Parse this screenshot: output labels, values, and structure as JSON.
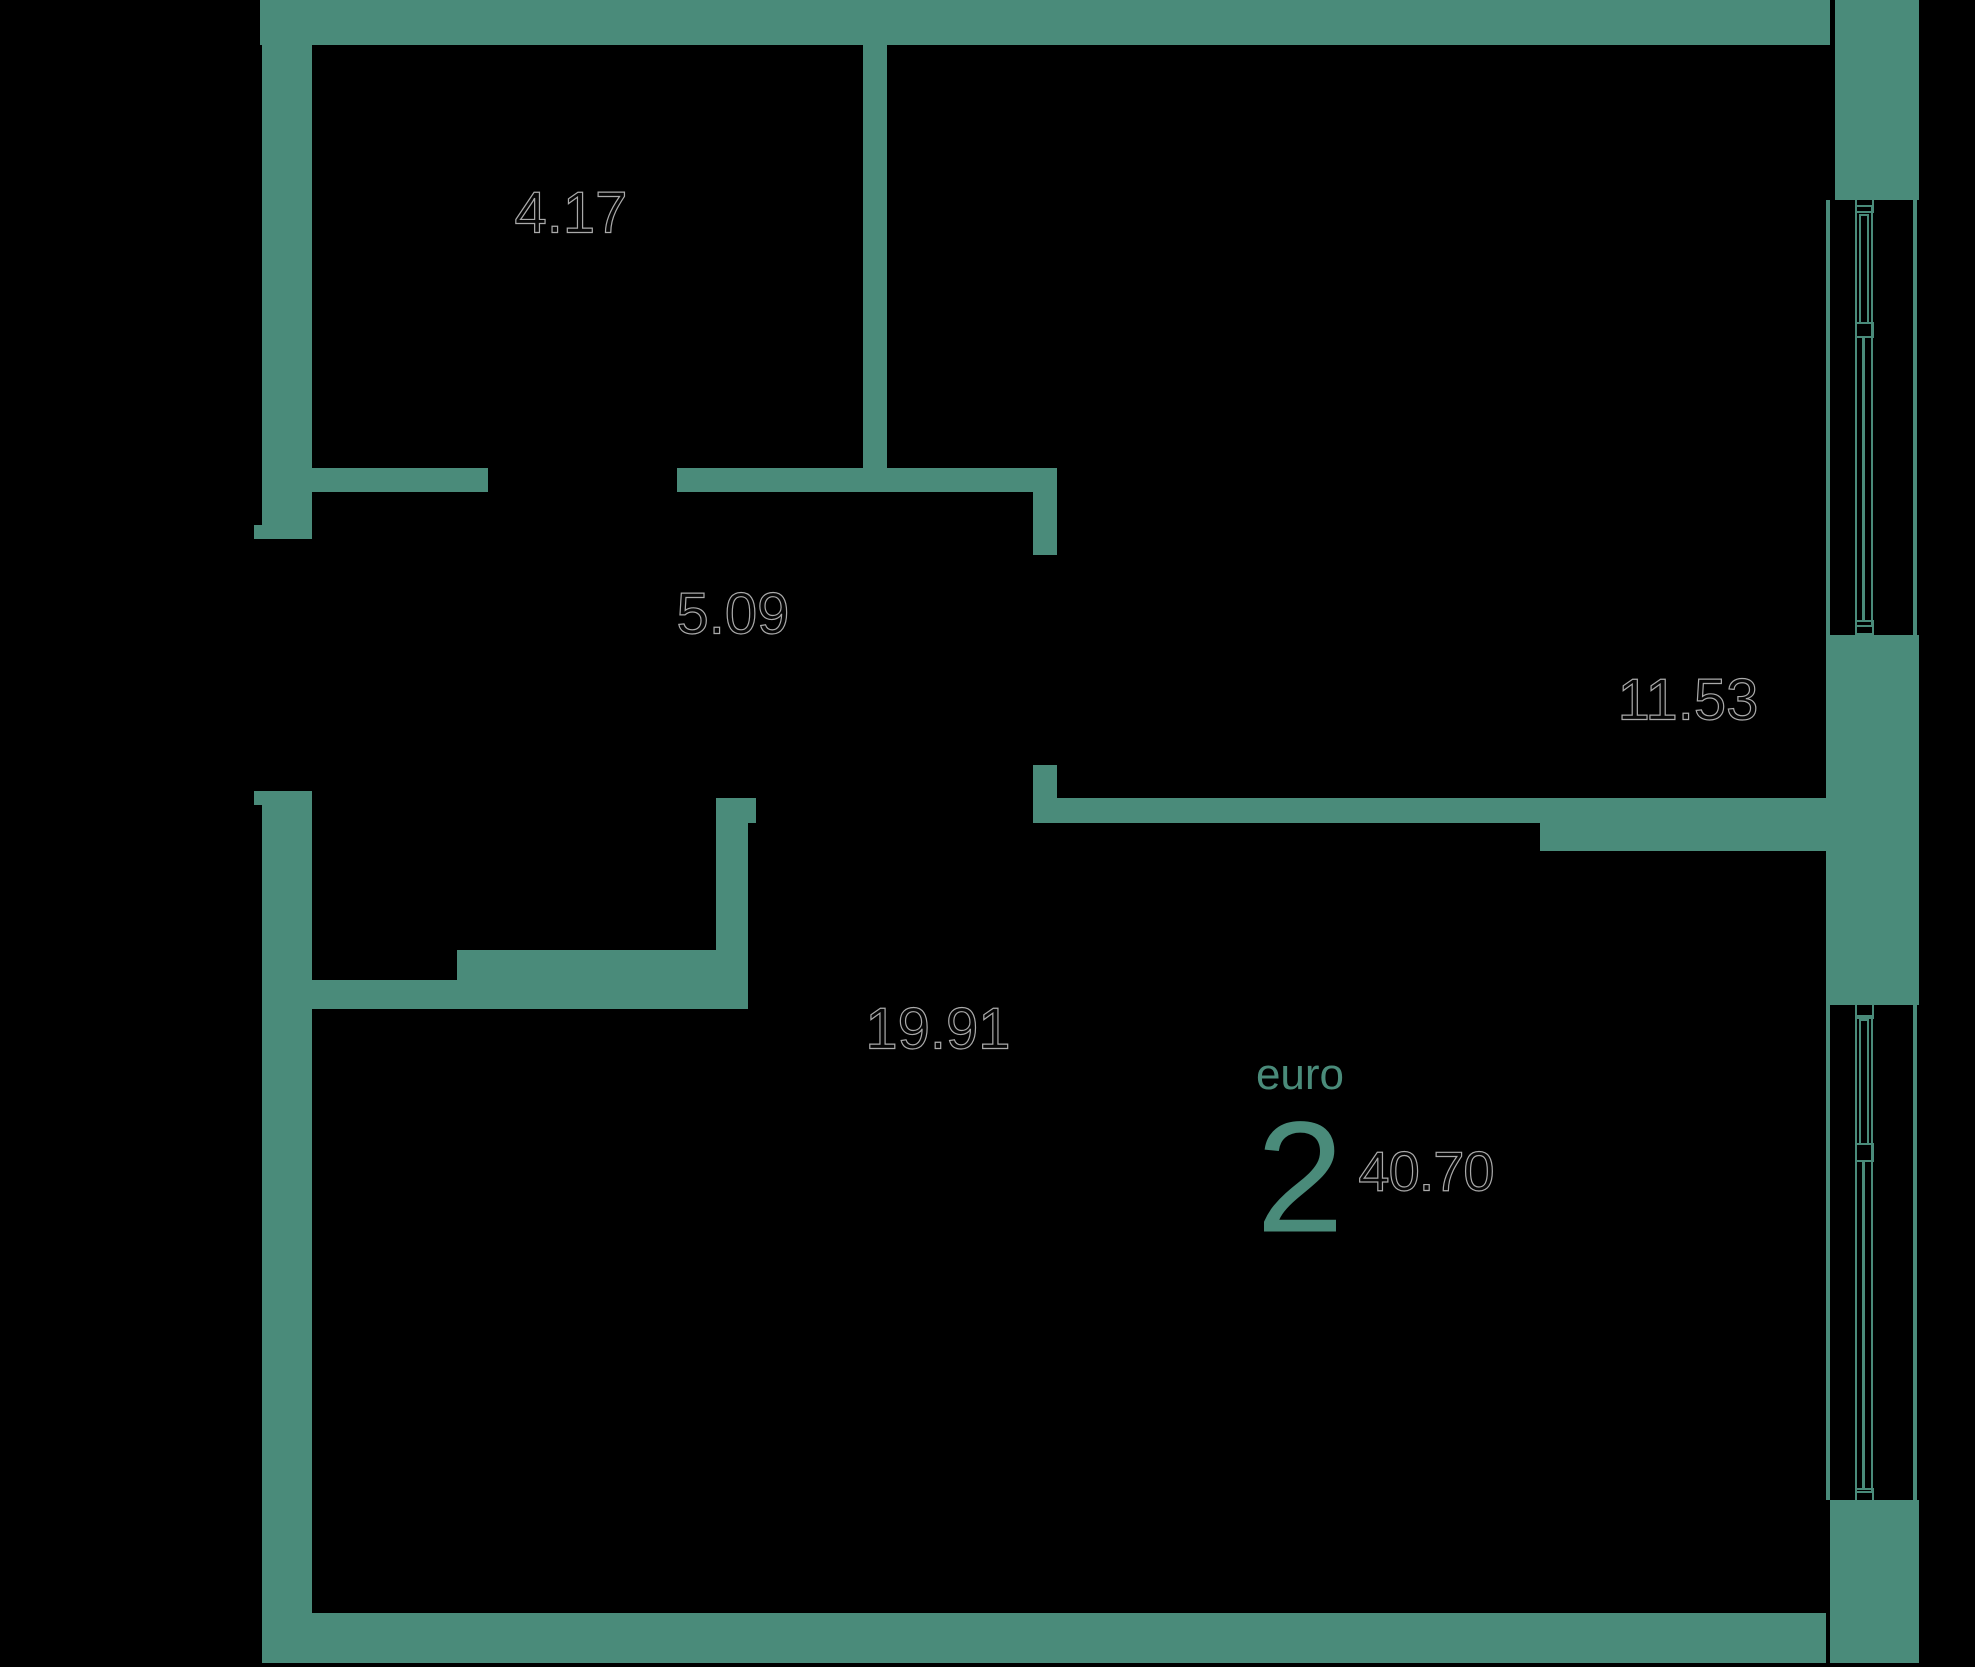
{
  "floorplan": {
    "title": "apartment-floor-plan",
    "colors": {
      "wall": "#4a8b7a",
      "background": "#000000",
      "dimension_text_fill": "#050505",
      "dimension_text_outline": "#aaaaaa",
      "accent_text": "#4a8b7a"
    },
    "rooms": [
      {
        "name": "bathroom",
        "area": "4.17"
      },
      {
        "name": "hallway",
        "area": "5.09"
      },
      {
        "name": "bedroom",
        "area": "11.53"
      },
      {
        "name": "living-kitchen",
        "area": "19.91"
      }
    ],
    "badge": {
      "layout_label": "euro",
      "rooms_count": "2",
      "total_area": "40.70"
    }
  },
  "geometry": {
    "solids": [
      {
        "x": 260,
        "y": 0,
        "w": 1570,
        "h": 45,
        "name": "top-outer-wall"
      },
      {
        "x": 1835,
        "y": 0,
        "w": 84,
        "h": 200,
        "name": "top-right-corner-block"
      },
      {
        "x": 262,
        "y": 0,
        "w": 50,
        "h": 539,
        "name": "left-outer-wall-upper"
      },
      {
        "x": 254,
        "y": 525,
        "w": 10,
        "h": 14,
        "name": "left-door-jamb-upper"
      },
      {
        "x": 262,
        "y": 791,
        "w": 50,
        "h": 872,
        "name": "left-outer-wall-lower"
      },
      {
        "x": 254,
        "y": 791,
        "w": 10,
        "h": 14,
        "name": "left-door-jamb-lower"
      },
      {
        "x": 262,
        "y": 1613,
        "w": 1564,
        "h": 50,
        "name": "bottom-outer-wall"
      },
      {
        "x": 1830,
        "y": 1500,
        "w": 89,
        "h": 163,
        "name": "bottom-right-corner-block"
      },
      {
        "x": 1826,
        "y": 635,
        "w": 93,
        "h": 370,
        "name": "right-wall-middle-block"
      },
      {
        "x": 863,
        "y": 45,
        "w": 24,
        "h": 447,
        "name": "bathroom-right-wall"
      },
      {
        "x": 312,
        "y": 468,
        "w": 176,
        "h": 24,
        "name": "bathroom-bottom-wall"
      },
      {
        "x": 677,
        "y": 468,
        "w": 380,
        "h": 24,
        "name": "hallway-top-wall"
      },
      {
        "x": 1033,
        "y": 492,
        "w": 24,
        "h": 63,
        "name": "bedroom-door-jamb-upper"
      },
      {
        "x": 1033,
        "y": 765,
        "w": 24,
        "h": 35,
        "name": "bedroom-door-jamb-lower"
      },
      {
        "x": 1033,
        "y": 798,
        "w": 795,
        "h": 25,
        "name": "bedroom-bottom-wall"
      },
      {
        "x": 1540,
        "y": 823,
        "w": 288,
        "h": 28,
        "name": "bedroom-bottom-wall-thick"
      },
      {
        "x": 716,
        "y": 798,
        "w": 32,
        "h": 211,
        "name": "hallway-left-wall"
      },
      {
        "x": 748,
        "y": 798,
        "w": 8,
        "h": 25,
        "name": "hallway-left-wall-stub"
      },
      {
        "x": 312,
        "y": 980,
        "w": 145,
        "h": 29,
        "name": "living-top-wall-thin"
      },
      {
        "x": 457,
        "y": 950,
        "w": 261,
        "h": 59,
        "name": "living-top-wall-thick"
      },
      {
        "x": 1826,
        "y": 200,
        "w": 4,
        "h": 435,
        "name": "window1-inner-line"
      },
      {
        "x": 1913,
        "y": 200,
        "w": 4,
        "h": 435,
        "name": "window1-outer-line"
      },
      {
        "x": 1862,
        "y": 338,
        "w": 3,
        "h": 282,
        "name": "window1-glazing-line"
      },
      {
        "x": 1826,
        "y": 1005,
        "w": 4,
        "h": 495,
        "name": "window2-inner-line"
      },
      {
        "x": 1913,
        "y": 1005,
        "w": 4,
        "h": 495,
        "name": "window2-outer-line"
      },
      {
        "x": 1862,
        "y": 1162,
        "w": 3,
        "h": 326,
        "name": "window2-glazing-line"
      }
    ],
    "frames": [
      {
        "x": 1855,
        "y": 205,
        "w": 18,
        "h": 422,
        "name": "window1-frame"
      },
      {
        "x": 1859,
        "y": 214,
        "w": 10,
        "h": 110,
        "name": "window1-sash"
      },
      {
        "x": 1855,
        "y": 197,
        "w": 19,
        "h": 16,
        "name": "window1-top-cap"
      },
      {
        "x": 1855,
        "y": 322,
        "w": 19,
        "h": 16,
        "name": "window1-mid-cap"
      },
      {
        "x": 1855,
        "y": 620,
        "w": 19,
        "h": 15,
        "name": "window1-bottom-cap"
      },
      {
        "x": 1855,
        "y": 1015,
        "w": 18,
        "h": 478,
        "name": "window2-frame"
      },
      {
        "x": 1859,
        "y": 1019,
        "w": 10,
        "h": 126,
        "name": "window2-sash"
      },
      {
        "x": 1855,
        "y": 1003,
        "w": 19,
        "h": 16,
        "name": "window2-top-cap"
      },
      {
        "x": 1855,
        "y": 1143,
        "w": 19,
        "h": 19,
        "name": "window2-mid-cap"
      },
      {
        "x": 1855,
        "y": 1488,
        "w": 19,
        "h": 15,
        "name": "window2-bottom-cap"
      }
    ]
  }
}
